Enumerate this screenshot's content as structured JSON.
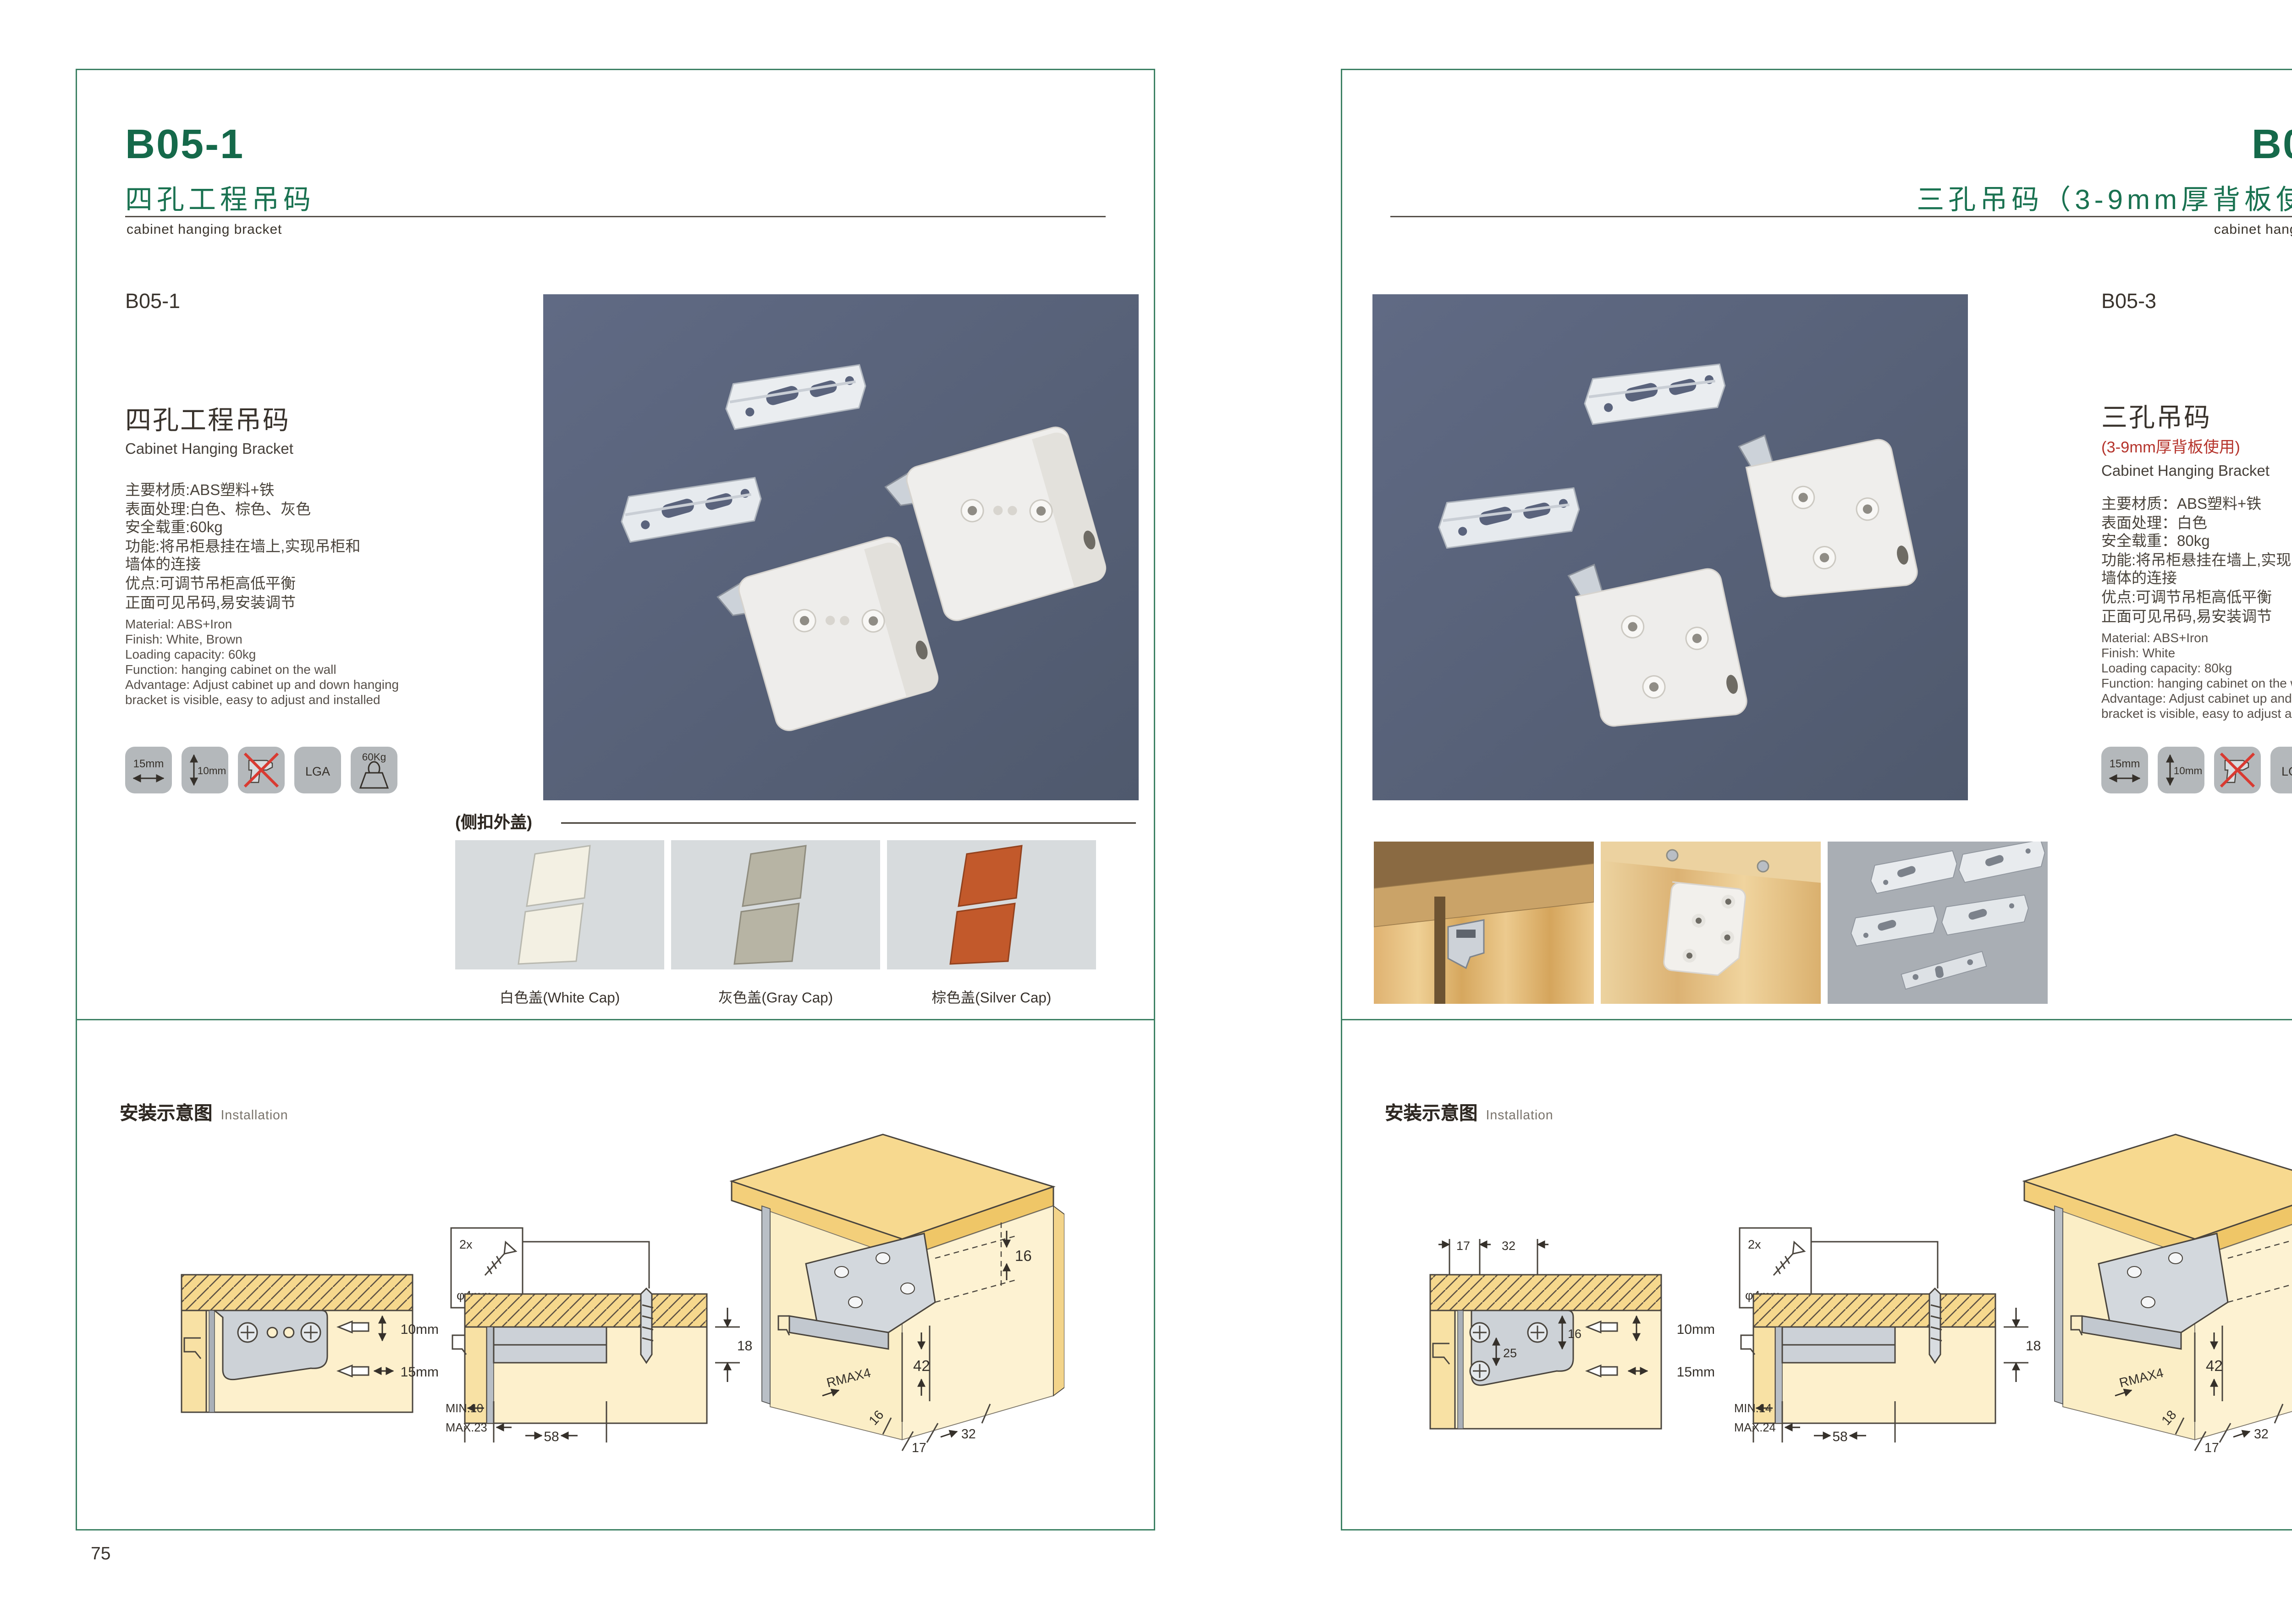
{
  "doc": {
    "pages": [
      {
        "header": {
          "code": "B05-1",
          "title_cn": "四孔工程吊码",
          "subtitle_en": "cabinet hanging bracket"
        },
        "product": {
          "code": "B05-1",
          "name_cn": "四孔工程吊码",
          "name_en": "Cabinet Hanging Bracket",
          "specs_cn": [
            "主要材质:ABS塑料+铁",
            "表面处理:白色、棕色、灰色",
            "安全载重:60kg",
            "功能:将吊柜悬挂在墙上,实现吊柜和",
            "墙体的连接",
            "优点:可调节吊柜高低平衡",
            "正面可见吊码,易安装调节"
          ],
          "specs_en": [
            "Material: ABS+Iron",
            "Finish: White, Brown",
            "Loading capacity: 60kg",
            "Function: hanging cabinet on the wall",
            "Advantage: Adjust cabinet up and down hanging",
            "bracket is visible, easy to adjust and installed"
          ],
          "icons": {
            "width": "15mm",
            "height": "10mm",
            "cert": "LGA",
            "load": "60Kg"
          }
        },
        "caps": {
          "label": "(侧扣外盖)",
          "items": [
            {
              "caption": "白色盖(White Cap)",
              "color": "#f3f0e3"
            },
            {
              "caption": "灰色盖(Gray Cap)",
              "color": "#b7b4a4"
            },
            {
              "caption": "棕色盖(Silver Cap)",
              "color": "#c2592b"
            }
          ]
        },
        "installation": {
          "title_cn": "安装示意图",
          "title_en": "Installation",
          "d1": {
            "dim_v": "10mm",
            "dim_h": "15mm"
          },
          "d2": {
            "screw_count": "2x",
            "screw_dia": "φ4mm",
            "thickness": "18",
            "min": "MIN.10",
            "max": "MAX.23",
            "depth": "58"
          },
          "d3": {
            "top": "16",
            "height": "42",
            "radius": "RMAX4",
            "side": "16",
            "off1": "17",
            "off2": "32"
          }
        },
        "page_number": "75"
      },
      {
        "header": {
          "code": "B05-3",
          "title_cn": "三孔吊码（3-9mm厚背板使用）",
          "subtitle_en": "cabinet hanging bracket"
        },
        "product": {
          "code": "B05-3",
          "name_cn": "三孔吊码",
          "name_note": "(3-9mm厚背板使用)",
          "name_en": "Cabinet Hanging Bracket",
          "specs_cn": [
            "主要材质：ABS塑料+铁",
            "表面处理：白色",
            "安全载重：80kg",
            "功能:将吊柜悬挂在墙上,实现吊柜和",
            "墙体的连接",
            "优点:可调节吊柜高低平衡",
            "正面可见吊码,易安装调节"
          ],
          "specs_en": [
            "Material: ABS+Iron",
            "Finish: White",
            "Loading capacity: 80kg",
            "Function: hanging cabinet on the wall",
            "Advantage: Adjust cabinet up and down hanging",
            "bracket is visible, easy to adjust and installed"
          ],
          "icons": {
            "width": "15mm",
            "height": "10mm",
            "cert": "LGA",
            "load": "80Kg"
          }
        },
        "installation": {
          "title_cn": "安装示意图",
          "title_en": "Installation",
          "d1": {
            "off1": "17",
            "off2": "32",
            "in1": "16",
            "in2": "25",
            "dim_v": "10mm",
            "dim_h": "15mm"
          },
          "d2": {
            "screw_count": "2x",
            "screw_dia": "φ4mm",
            "thickness": "18",
            "min": "MIN.14",
            "max": "MAX.24",
            "depth": "58"
          },
          "d3": {
            "top": "16",
            "height": "42",
            "radius": "RMAX4",
            "side": "18",
            "off1": "17",
            "off2": "32"
          }
        },
        "page_number": "76"
      }
    ]
  }
}
